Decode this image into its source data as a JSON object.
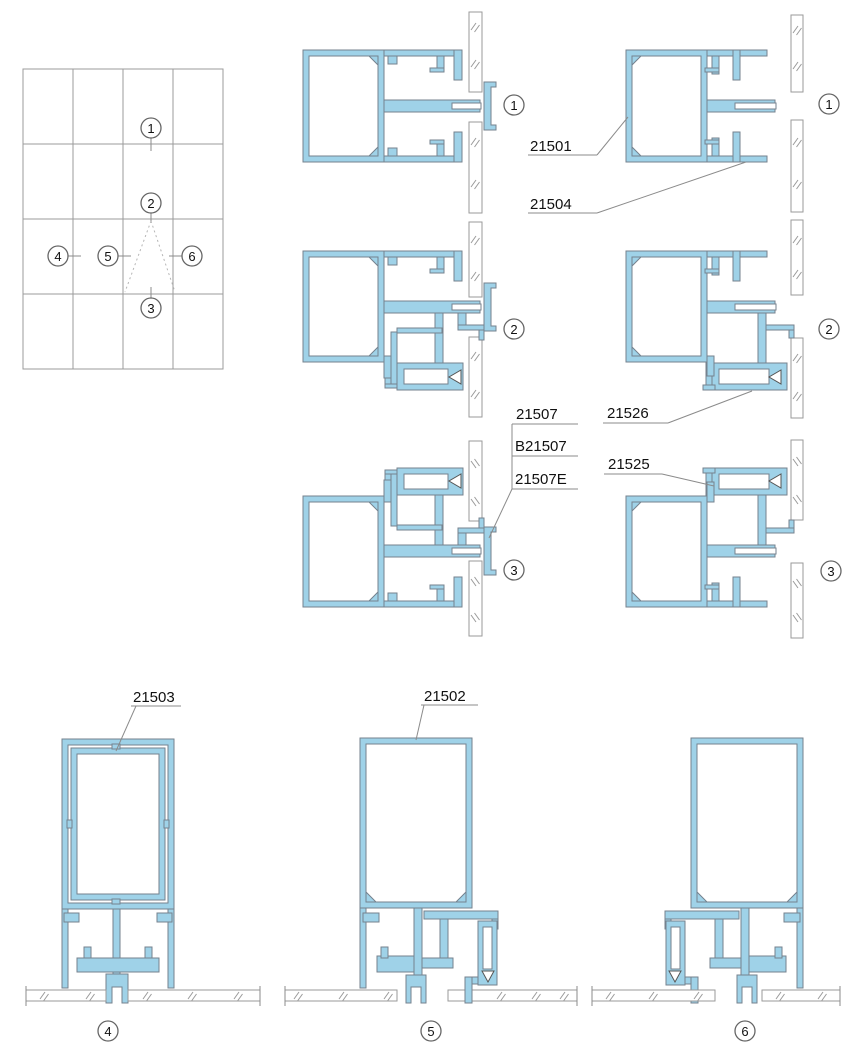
{
  "drawing": {
    "type": "curtain-wall-node-details",
    "colors": {
      "profile_fill": "#9fd2e8",
      "profile_stroke": "#75828e",
      "line_gray": "#8b8b8b",
      "text": "#111111"
    }
  },
  "callouts": {
    "n1": "1",
    "n2": "2",
    "n3": "3",
    "n4": "4",
    "n5": "5",
    "n6": "6"
  },
  "part_labels": {
    "p21501": "21501",
    "p21504": "21504",
    "p21507": "21507",
    "pB21507": "B21507",
    "p21507E": "21507E",
    "p21526": "21526",
    "p21525": "21525",
    "p21503": "21503",
    "p21502": "21502"
  }
}
